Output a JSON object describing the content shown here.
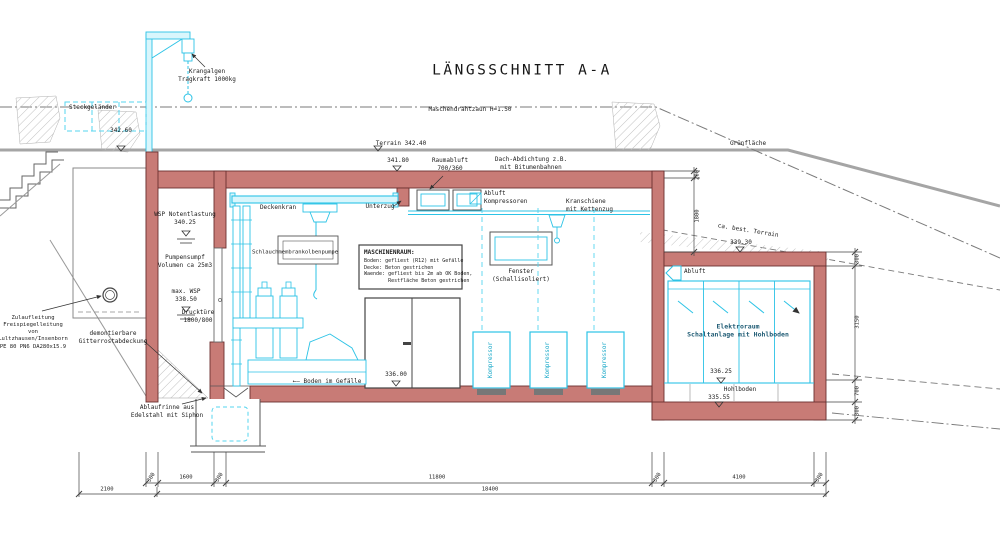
{
  "drawing": {
    "title": "LÄNGSSCHNITT A-A"
  },
  "annotations": {
    "krangalgen": "Krangalgen\nTragkraft 1000kg",
    "steckgelaender": "Steckgeländer",
    "maschendrahtzaun": "Maschendrahtzaun H=1.50",
    "terrain": "Terrain 342.40",
    "gruenflaeche": "Grünfläche",
    "ca_best_terrain": "ca. best. Terrain",
    "level_342_60": "342.60",
    "level_341_80": "341.80",
    "level_339_30": "339.30",
    "level_336_00": "336.00",
    "level_336_25": "336.25",
    "level_335_55": "335.55",
    "wsp_notentlastung": "WSP Notentlastung\n340.25",
    "pumpensumpf": "Pumpensumpf\nVolumen ca 25m3",
    "max_wsp": "max. WSP\n338.50",
    "drucktuere": "Drucktüre\n1800/800",
    "zulaufleitung": "Zulaufleitung\nFreispiegelleitung von\nLultzhausen/Insenborn\nPE 80 PN6 DA280x15.9",
    "demontierbare": "demontierbare\nGitterrostabdeckung",
    "ablaufrinne": "Ablaufrinne aus\nEdelstahl mit Siphon",
    "deckenkran": "Deckenkran",
    "unterzug": "Unterzug",
    "schlauchpumpe": "Schlauchmembrankolbenpumpe",
    "raumabluft": "Raumabluft\n700/360",
    "dach_abdichtung": "Dach-Abdichtung z.B.\nmit Bitumenbahnen",
    "abluft_kompressoren": "Abluft\nKompressoren",
    "kranschiene": "Kranschiene\nmit Kettenzug",
    "abluft": "Abluft",
    "fenster": "Fenster\n(Schallisoliert)",
    "boden_gefaelle": "←– Boden im Gefälle",
    "kompressor": "Kompressor",
    "elektroraum": "Elektroraum\nSchaltanlage mit Hohlboden",
    "hohlboden": "Hohlboden",
    "maschinenraum_titel": "MASCHINENRAUM:",
    "maschinenraum_spec": "Boden: gefliest (R12) mit Gefälle\nDecke: Beton gestrichen\nWaende: gefliest bis 2m ab OK Boden,\n        Restfläche Beton gestrichen"
  },
  "dimensions": {
    "bottom": [
      "300",
      "1600",
      "300",
      "11800",
      "300",
      "4100",
      "300"
    ],
    "bottom_totals": [
      "2100",
      "18400"
    ],
    "right": [
      "300",
      "3150",
      "700",
      "300"
    ],
    "step": [
      "200",
      "1800"
    ]
  },
  "colors": {
    "wall": "#c87b76",
    "equipment": "#2cc3e6",
    "terrain": "#a5a5a5"
  }
}
